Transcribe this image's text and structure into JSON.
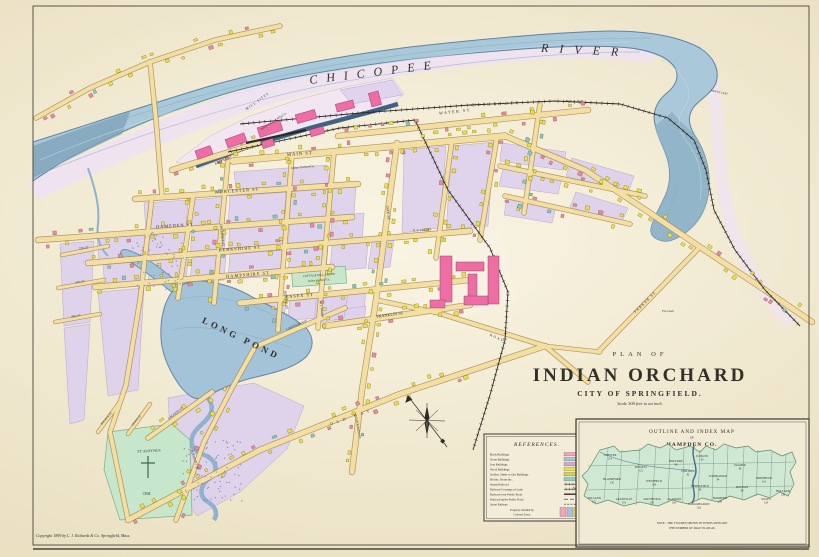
{
  "plate": {
    "title_plan_of": "PLAN OF",
    "title_name": "INDIAN ORCHARD",
    "title_city": "CITY OF SPRINGFIELD.",
    "title_scale": "Scale 300 feet to an inch.",
    "copyright": "Copyright 1899 by L. J. Richards & Co. Springfield, Mass."
  },
  "river": {
    "name_part1": "CHICOPEE",
    "name_part2": "RIVER",
    "indian_leap": "INDIAN LEAP"
  },
  "railroad": {
    "athol_branch": "ATHOL BRANCH",
    "company": "B. & A. R. R."
  },
  "streets": {
    "water": "WATER ST",
    "main": "MAIN ST",
    "front": "FRONT ST",
    "worcester": "WORCESTER ST",
    "hampden": "HAMPDEN ST",
    "berkshire": "BERKSHIRE ST",
    "hampshire": "HAMPSHIRE ST",
    "essex": "ESSEX ST",
    "franklin": "FRANKLIN ST",
    "chestnut": "CHESTNUT ST",
    "myrtle": "MYRTLE ST",
    "oak": "OAK ST",
    "goodwin": "GOODWIN ST",
    "lakeside": "LAKESIDE AVE",
    "pleasant": "PLEASANT ST",
    "lagoon": "LAGOON ST",
    "bourne": "BOURNE ST",
    "grove": "GROVE ST",
    "fifth": "5TH ST",
    "fourth": "4TH ST",
    "third": "3RD ST",
    "parker": "PARKER ST",
    "old_bay": "OLD BAY",
    "road": "ROAD"
  },
  "features": {
    "long_pond": "LONG POND",
    "cemetery_line1": "ST. ALOYSIUS",
    "cemetery_line2": "CEM.",
    "grove_line1": "COTTAGE HILL GROVE",
    "grove_line2": "Indian Orchard Co.",
    "mill_sites": "MILL SITES",
    "mill_co": "Indian Orchard M'f'g Co.",
    "indian_orchard_co": "Indian Orchard Co.",
    "ne_freight": "N. E. FR'GHT",
    "goodwin_owner": "C. J. Goodwin",
    "fox_lawn": "Fox Lawn"
  },
  "references": {
    "title": "REFERENCES.",
    "rows": [
      {
        "label": "Brick Buildings",
        "swatch": "#f2a3c0"
      },
      {
        "label": "Stone Buildings",
        "swatch": "#a8c0dd"
      },
      {
        "label": "Iron Buildings",
        "swatch": "#c6abdb"
      },
      {
        "label": "Wood Buildings",
        "swatch": "#efe03c"
      },
      {
        "label": "Stables, Sheds or Out Buildings",
        "swatch": "#ccd05c"
      },
      {
        "label": "Blocks, Stores &c.",
        "swatch": "#87d2c7"
      },
      {
        "label": "Steam Railroad",
        "swatch": "rr"
      },
      {
        "label": "Railroad Crossing at Grade",
        "swatch": "rr-grade"
      },
      {
        "label": "Railroad over Public Road",
        "swatch": "rr-over"
      },
      {
        "label": "Railroad under Public Road",
        "swatch": "rr-under"
      },
      {
        "label": "Street Railway",
        "swatch": "street-ry"
      }
    ],
    "note_line1": "Property divided by",
    "note_line2": "Colored Lines."
  },
  "inset": {
    "title_line1": "OUTLINE AND INDEX MAP",
    "title_of": "OF",
    "title_line2": "HAMPDEN CO.",
    "note_line1": "NOTE : THE FIGURES SHOWN IN TOWNS INDICATE",
    "note_line2": "THE NUMBER OF PAGE IN ATLAS.",
    "towns": [
      {
        "name": "CHESTER",
        "page": "114"
      },
      {
        "name": "BLANDFORD",
        "page": "120"
      },
      {
        "name": "RUSSELL",
        "page": "112"
      },
      {
        "name": "TOLLAND",
        "page": "122"
      },
      {
        "name": "GRANVILLE",
        "page": "118"
      },
      {
        "name": "SOUTHWICK",
        "page": "108"
      },
      {
        "name": "WESTFIELD",
        "page": "104"
      },
      {
        "name": "AGAWAM",
        "page": "100"
      },
      {
        "name": "HOLYOKE",
        "page": "96"
      },
      {
        "name": "CHICOPEE",
        "page": "92"
      },
      {
        "name": "SPRINGFIELD",
        "page": "88"
      },
      {
        "name": "LUDLOW",
        "page": "90"
      },
      {
        "name": "WILBRAHAM",
        "page": "94"
      },
      {
        "name": "HAMPDEN",
        "page": "106"
      },
      {
        "name": "PALMER",
        "page": "86"
      },
      {
        "name": "MONSON",
        "page": "98"
      },
      {
        "name": "BRIMFIELD",
        "page": "116"
      },
      {
        "name": "WALES",
        "page": "124"
      },
      {
        "name": "HOLLAND",
        "page": "126"
      },
      {
        "name": "LONGMEADOW",
        "page": "102"
      }
    ]
  }
}
